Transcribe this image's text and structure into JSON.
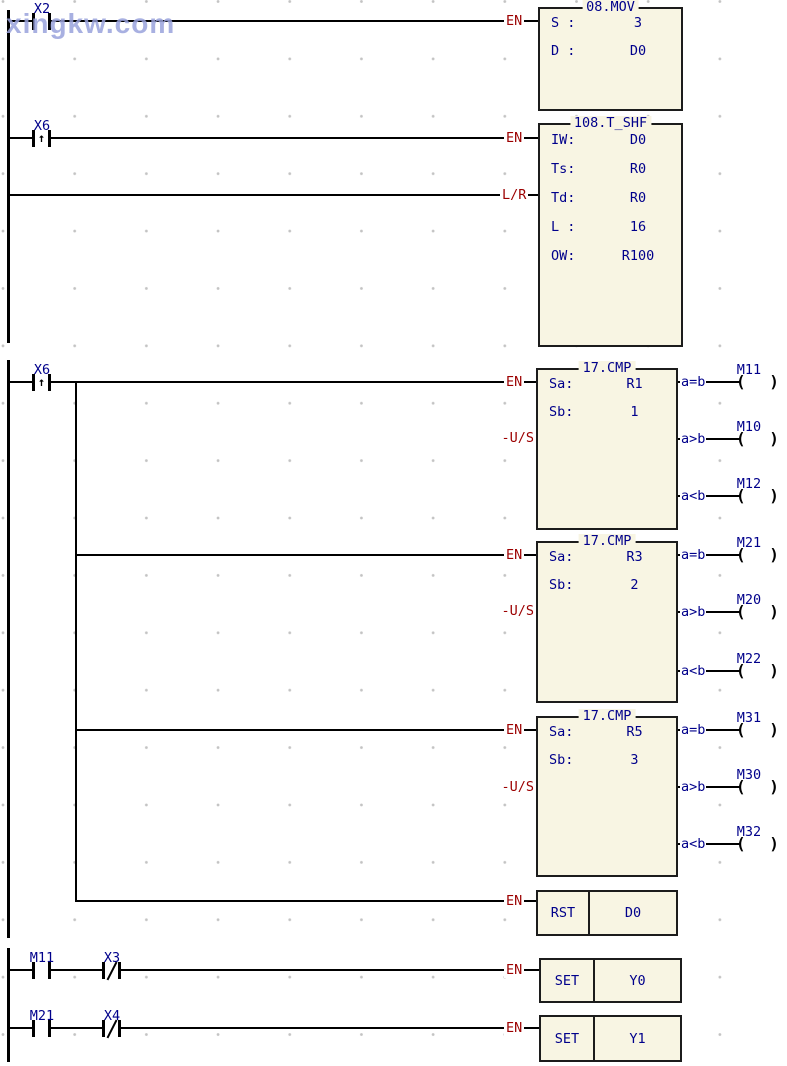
{
  "watermark": "xingkw.com",
  "symbols": {
    "coil": "( )",
    "rising_edge": "↑"
  },
  "colors": {
    "text_navy": "#00008b",
    "text_maroon": "#9c0000",
    "block_fill": "#f8f5e3",
    "line_black": "#000000",
    "watermark_blue": "#9aa3dc"
  },
  "connector_labels": {
    "en": "EN",
    "lr": "L/R",
    "us": "-U/S"
  },
  "contacts": {
    "x2": {
      "label": "X2",
      "type": "normally-open"
    },
    "x6_shift": {
      "label": "X6",
      "type": "rising-edge"
    },
    "x6_cmp": {
      "label": "X6",
      "type": "rising-edge"
    },
    "m11": {
      "label": "M11",
      "type": "normally-open"
    },
    "x3": {
      "label": "X3",
      "type": "normally-closed"
    },
    "m21": {
      "label": "M21",
      "type": "normally-open"
    },
    "x4": {
      "label": "X4",
      "type": "normally-closed"
    }
  },
  "blocks": {
    "mov": {
      "title": "08.MOV",
      "rows": [
        {
          "label": "S :",
          "value": "3"
        },
        {
          "label": "D :",
          "value": "D0"
        }
      ]
    },
    "tshf": {
      "title": "108.T_SHF",
      "rows": [
        {
          "label": "IW:",
          "value": "D0"
        },
        {
          "label": "Ts:",
          "value": "R0"
        },
        {
          "label": "Td:",
          "value": "R0"
        },
        {
          "label": "L :",
          "value": "16"
        },
        {
          "label": "OW:",
          "value": "R100"
        }
      ]
    },
    "cmp1": {
      "title": "17.CMP",
      "rows": [
        {
          "label": "Sa:",
          "value": "R1"
        },
        {
          "label": "Sb:",
          "value": "1"
        }
      ],
      "outputs": [
        {
          "cond": "a=b",
          "coil": "M11"
        },
        {
          "cond": "a>b",
          "coil": "M10"
        },
        {
          "cond": "a<b",
          "coil": "M12"
        }
      ]
    },
    "cmp2": {
      "title": "17.CMP",
      "rows": [
        {
          "label": "Sa:",
          "value": "R3"
        },
        {
          "label": "Sb:",
          "value": "2"
        }
      ],
      "outputs": [
        {
          "cond": "a=b",
          "coil": "M21"
        },
        {
          "cond": "a>b",
          "coil": "M20"
        },
        {
          "cond": "a<b",
          "coil": "M22"
        }
      ]
    },
    "cmp3": {
      "title": "17.CMP",
      "rows": [
        {
          "label": "Sa:",
          "value": "R5"
        },
        {
          "label": "Sb:",
          "value": "3"
        }
      ],
      "outputs": [
        {
          "cond": "a=b",
          "coil": "M31"
        },
        {
          "cond": "a>b",
          "coil": "M30"
        },
        {
          "cond": "a<b",
          "coil": "M32"
        }
      ]
    },
    "rst": {
      "op": "RST",
      "operand": "D0"
    },
    "set_y0": {
      "op": "SET",
      "operand": "Y0"
    },
    "set_y1": {
      "op": "SET",
      "operand": "Y1"
    }
  }
}
